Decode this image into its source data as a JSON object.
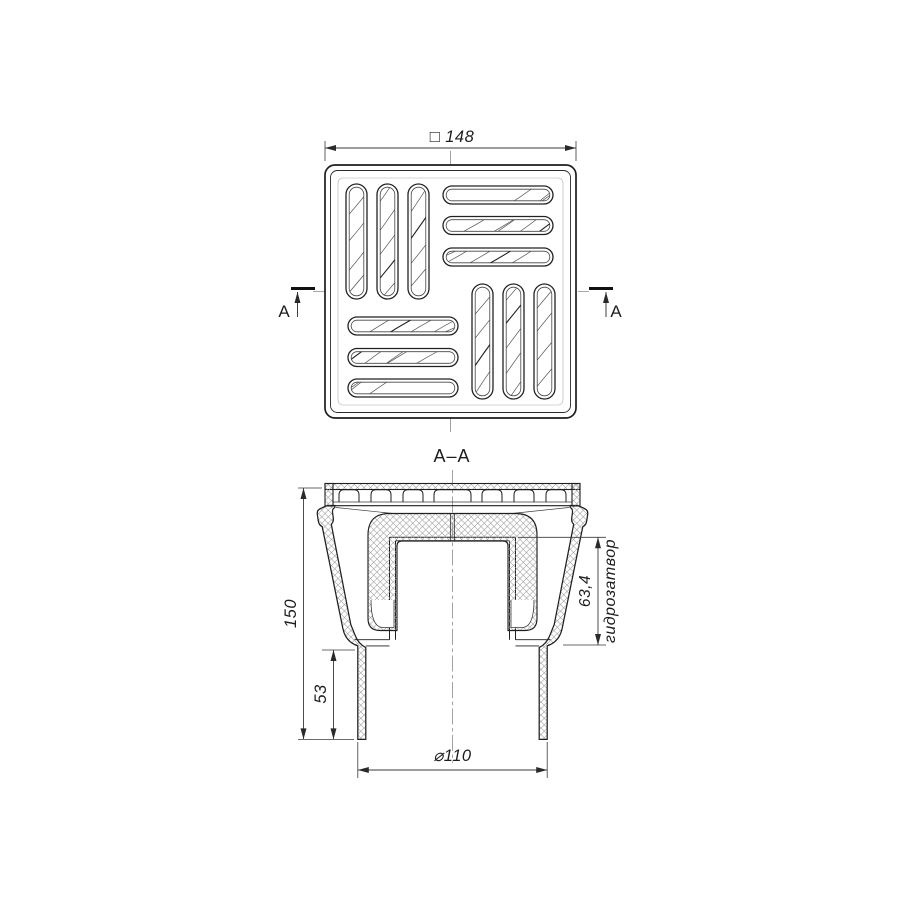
{
  "drawing": {
    "top_view": {
      "width_dim_label": "□ 148",
      "cut_letter_left": "A",
      "cut_letter_right": "A"
    },
    "section_view": {
      "title": "A–A",
      "overall_height_label": "150",
      "spigot_height_label": "53",
      "seal_height_label": "63,4",
      "seal_name_label": "гидрозатвор",
      "pipe_diameter_label": "⌀110"
    }
  }
}
